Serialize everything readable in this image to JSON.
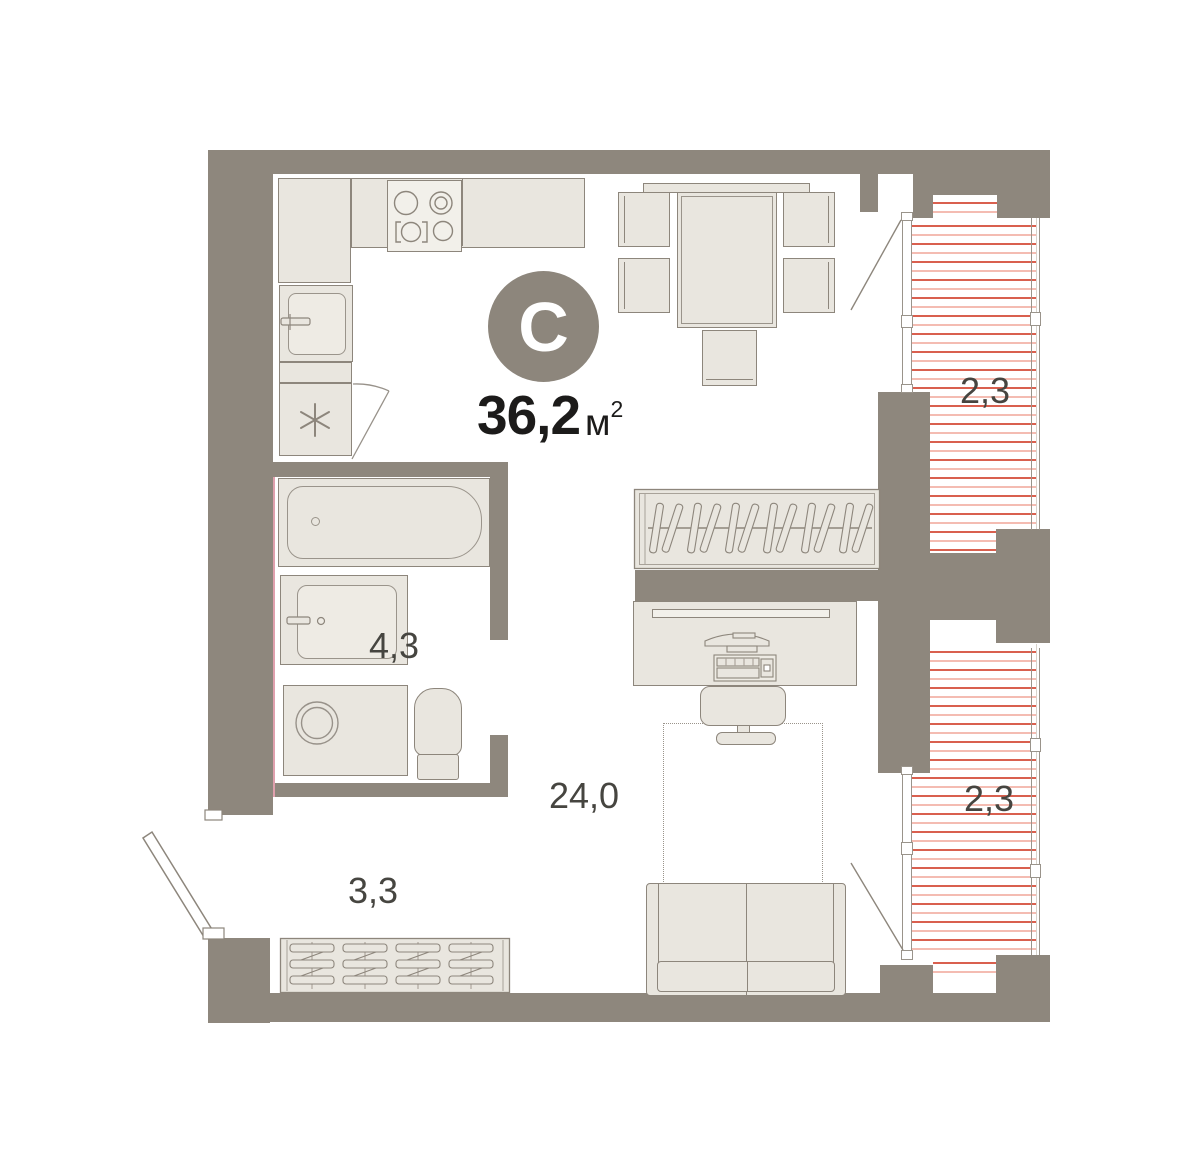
{
  "badge": {
    "letter": "С"
  },
  "total": {
    "value": "36,2",
    "unit": "м",
    "sup": "2"
  },
  "room_labels": {
    "balcony_top": "2,3",
    "balcony_bottom": "2,3",
    "bathroom": "4,3",
    "living": "24,0",
    "hallway": "3,3"
  },
  "icons": [
    "fridge-asterisk-icon",
    "stove-burners-icon",
    "sink-icon",
    "bathtub-icon",
    "washer-icon",
    "toilet-icon",
    "wardrobe-hangers-icon",
    "shoe-rack-icon",
    "door-swing-icon",
    "window-icon"
  ],
  "colors": {
    "wall": "#8e877d",
    "furn_fill": "#e9e6df",
    "furn_stroke": "#8d867c",
    "hatch_dark": "#d9604f",
    "hatch_light": "#f4bcb2",
    "window_line": "#9a948b",
    "badge_bg": "#8d867c",
    "badge_text": "#ffffff",
    "label_color": "#464540",
    "accent_pink": "#dfa0ad"
  }
}
